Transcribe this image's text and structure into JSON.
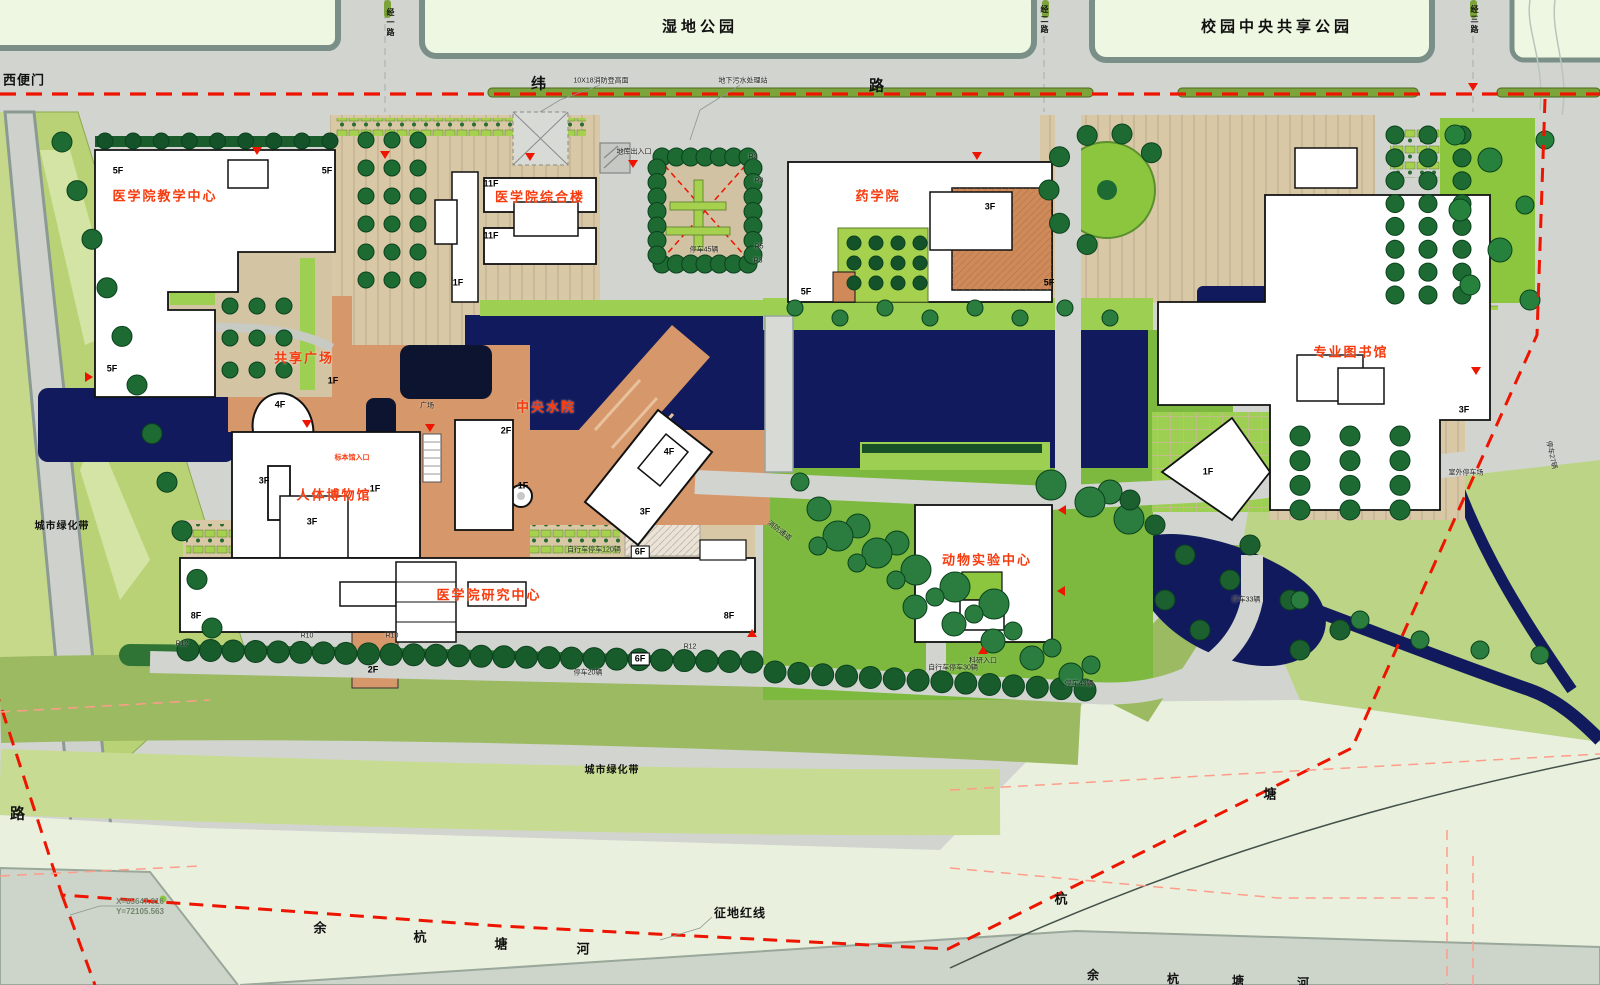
{
  "map_type": "campus-master-site-plan",
  "colors": {
    "road_grey": "#d2d4cf",
    "park_pale": "#eef7e2",
    "curb": "#7b8f89",
    "paving_tan": "#d8c8a6",
    "plaza_salmon": "#d6976a",
    "lawn_lime": "#9ccf52",
    "park_green": "#7cb93e",
    "belt_green": "#b9d275",
    "water_navy": "#111a5c",
    "tree_green": "#1d6a32",
    "red_line": "#ee1500",
    "label_red": "#f63b0e",
    "river_mint": "#e9f1de",
    "river_grey": "#cdd4ca",
    "building_white": "#ffffff"
  },
  "red_building_labels": [
    {
      "name": "label-medical-teaching-center",
      "t": "医学院教学中心",
      "x": 165,
      "y": 196
    },
    {
      "name": "label-medical-complex-building",
      "t": "医学院综合楼",
      "x": 540,
      "y": 197
    },
    {
      "name": "label-pharmacy-school",
      "t": "药学院",
      "x": 878,
      "y": 196
    },
    {
      "name": "label-specialty-library",
      "t": "专业图书馆",
      "x": 1351,
      "y": 352
    },
    {
      "name": "label-shared-plaza",
      "t": "共享广场",
      "x": 304,
      "y": 358
    },
    {
      "name": "label-central-water-court",
      "t": "中央水院",
      "x": 546,
      "y": 407
    },
    {
      "name": "label-human-body-museum",
      "t": "人体博物馆",
      "x": 334,
      "y": 495
    },
    {
      "name": "label-medical-research-center",
      "t": "医学院研究中心",
      "x": 489,
      "y": 595
    },
    {
      "name": "label-animal-lab-center",
      "t": "动物实验中心",
      "x": 987,
      "y": 560
    },
    {
      "name": "label-specimen-hall-entrance",
      "t": "标本馆入口",
      "x": 352,
      "y": 458,
      "fs": 7,
      "ls": 0
    }
  ],
  "area_labels": [
    {
      "name": "label-wetland-park",
      "t": "湿地公园",
      "x": 700,
      "y": 27,
      "fs": 15
    },
    {
      "name": "label-central-shared-park",
      "t": "校园中央共享公园",
      "x": 1277,
      "y": 27,
      "fs": 15
    },
    {
      "name": "label-west-side-gate",
      "t": "西便门",
      "x": 24,
      "y": 80,
      "fs": 13,
      "ls": 1
    },
    {
      "name": "label-city-greenbelt-west",
      "t": "城市绿化带",
      "x": 62,
      "y": 527,
      "fs": 10,
      "ls": 1
    },
    {
      "name": "label-city-greenbelt-south",
      "t": "城市绿化带",
      "x": 612,
      "y": 771,
      "fs": 10,
      "ls": 1
    },
    {
      "name": "label-land-acquisition-red-line",
      "t": "征地红线",
      "x": 740,
      "y": 913,
      "fs": 12,
      "ls": 1
    },
    {
      "name": "label-river-char-yu",
      "t": "余",
      "x": 322,
      "y": 928,
      "fs": 13
    },
    {
      "name": "label-river-char-hang",
      "t": "杭",
      "x": 422,
      "y": 937,
      "fs": 13
    },
    {
      "name": "label-river-char-tang",
      "t": "塘",
      "x": 503,
      "y": 944,
      "fs": 13
    },
    {
      "name": "label-river-char-he",
      "t": "河",
      "x": 585,
      "y": 949,
      "fs": 13
    },
    {
      "name": "label-river-char-hang-2",
      "t": "杭",
      "x": 1063,
      "y": 899,
      "fs": 13
    },
    {
      "name": "label-river-char-tang-2",
      "t": "塘",
      "x": 1272,
      "y": 794,
      "fs": 13
    },
    {
      "name": "label-river-char-yu-3",
      "t": "余",
      "x": 1095,
      "y": 975,
      "fs": 12
    },
    {
      "name": "label-river-char-hang-3",
      "t": "杭",
      "x": 1175,
      "y": 979,
      "fs": 12
    },
    {
      "name": "label-river-char-tang-3",
      "t": "塘",
      "x": 1240,
      "y": 981,
      "fs": 12
    },
    {
      "name": "label-river-char-he-3",
      "t": "河",
      "x": 1305,
      "y": 983,
      "fs": 12
    }
  ],
  "road_labels": [
    {
      "name": "label-wei-road-char-1",
      "t": "纬",
      "x": 539,
      "y": 84,
      "fs": 15
    },
    {
      "name": "label-wei-road-char-2",
      "t": "路",
      "x": 877,
      "y": 86,
      "fs": 15
    },
    {
      "name": "label-west-road",
      "t": "路",
      "x": 18,
      "y": 814,
      "fs": 15
    },
    {
      "name": "label-jing-1-road",
      "t": "经一路",
      "x": 390,
      "y": 8,
      "fs": 8,
      "vert": true
    },
    {
      "name": "label-jing-2-road",
      "t": "经二路",
      "x": 1044,
      "y": 5,
      "fs": 8,
      "vert": true
    },
    {
      "name": "label-jing-3-road",
      "t": "经三路",
      "x": 1474,
      "y": 5,
      "fs": 8,
      "vert": true
    }
  ],
  "floor_labels": [
    {
      "t": "5F",
      "x": 118,
      "y": 171
    },
    {
      "t": "5F",
      "x": 327,
      "y": 171
    },
    {
      "t": "5F",
      "x": 112,
      "y": 369
    },
    {
      "t": "5F",
      "x": 806,
      "y": 292
    },
    {
      "t": "5F",
      "x": 1049,
      "y": 283
    },
    {
      "t": "11F",
      "x": 491,
      "y": 184
    },
    {
      "t": "11F",
      "x": 491,
      "y": 236
    },
    {
      "t": "1F",
      "x": 458,
      "y": 283
    },
    {
      "t": "1F",
      "x": 333,
      "y": 381
    },
    {
      "t": "1F",
      "x": 375,
      "y": 489
    },
    {
      "t": "1F",
      "x": 523,
      "y": 486
    },
    {
      "t": "1F",
      "x": 1208,
      "y": 472
    },
    {
      "t": "4F",
      "x": 280,
      "y": 405
    },
    {
      "t": "4F",
      "x": 669,
      "y": 452
    },
    {
      "t": "3F",
      "x": 264,
      "y": 481
    },
    {
      "t": "3F",
      "x": 312,
      "y": 522
    },
    {
      "t": "3F",
      "x": 990,
      "y": 207
    },
    {
      "t": "3F",
      "x": 1464,
      "y": 410
    },
    {
      "t": "3F",
      "x": 645,
      "y": 512
    },
    {
      "t": "2F",
      "x": 506,
      "y": 431
    },
    {
      "t": "2F",
      "x": 373,
      "y": 670
    },
    {
      "t": "6F",
      "x": 640,
      "y": 552,
      "box": true
    },
    {
      "t": "6F",
      "x": 640,
      "y": 659,
      "box": true
    },
    {
      "t": "8F",
      "x": 196,
      "y": 616
    },
    {
      "t": "8F",
      "x": 729,
      "y": 616
    }
  ],
  "annotations": [
    {
      "t": "10X18消防登高面",
      "x": 601,
      "y": 81
    },
    {
      "t": "地下污水处理站",
      "x": 743,
      "y": 81
    },
    {
      "t": "地库出入口",
      "x": 634,
      "y": 152
    },
    {
      "t": "停车45辆",
      "x": 704,
      "y": 250
    },
    {
      "t": "R3",
      "x": 753,
      "y": 157
    },
    {
      "t": "R3",
      "x": 759,
      "y": 181
    },
    {
      "t": "R5",
      "x": 759,
      "y": 247
    },
    {
      "t": "R3",
      "x": 758,
      "y": 261
    },
    {
      "t": "广场",
      "x": 427,
      "y": 406
    },
    {
      "t": "消防通道",
      "x": 779,
      "y": 531,
      "rot": 38
    },
    {
      "t": "自行车停车120辆",
      "x": 594,
      "y": 550
    },
    {
      "t": "停车20辆",
      "x": 588,
      "y": 673
    },
    {
      "t": "R12",
      "x": 182,
      "y": 644
    },
    {
      "t": "R10",
      "x": 307,
      "y": 636
    },
    {
      "t": "R10",
      "x": 392,
      "y": 636
    },
    {
      "t": "R12",
      "x": 690,
      "y": 647
    },
    {
      "t": "科研入口",
      "x": 983,
      "y": 661
    },
    {
      "t": "自行车停车30辆",
      "x": 953,
      "y": 668
    },
    {
      "t": "停车43辆",
      "x": 1079,
      "y": 684
    },
    {
      "t": "室外停车场",
      "x": 1466,
      "y": 473
    },
    {
      "t": "停车27辆",
      "x": 1551,
      "y": 455,
      "rot": 78
    },
    {
      "t": "停车33辆",
      "x": 1246,
      "y": 600
    }
  ],
  "survey_point": {
    "x_text": "X=85647.916",
    "y_text": "Y=72105.563",
    "x": 140,
    "y": 902
  },
  "markers": [
    {
      "x": 89,
      "y": 377,
      "dir": "right"
    },
    {
      "x": 257,
      "y": 151,
      "dir": "down"
    },
    {
      "x": 385,
      "y": 155,
      "dir": "down"
    },
    {
      "x": 530,
      "y": 157,
      "dir": "down"
    },
    {
      "x": 633,
      "y": 164,
      "dir": "down"
    },
    {
      "x": 977,
      "y": 156,
      "dir": "down"
    },
    {
      "x": 307,
      "y": 424,
      "dir": "down"
    },
    {
      "x": 430,
      "y": 428,
      "dir": "down"
    },
    {
      "x": 1062,
      "y": 510,
      "dir": "left"
    },
    {
      "x": 1061,
      "y": 591,
      "dir": "left"
    },
    {
      "x": 983,
      "y": 650,
      "dir": "up"
    },
    {
      "x": 1473,
      "y": 87,
      "dir": "down"
    },
    {
      "x": 752,
      "y": 633,
      "dir": "up"
    },
    {
      "x": 1476,
      "y": 371,
      "dir": "down"
    }
  ]
}
